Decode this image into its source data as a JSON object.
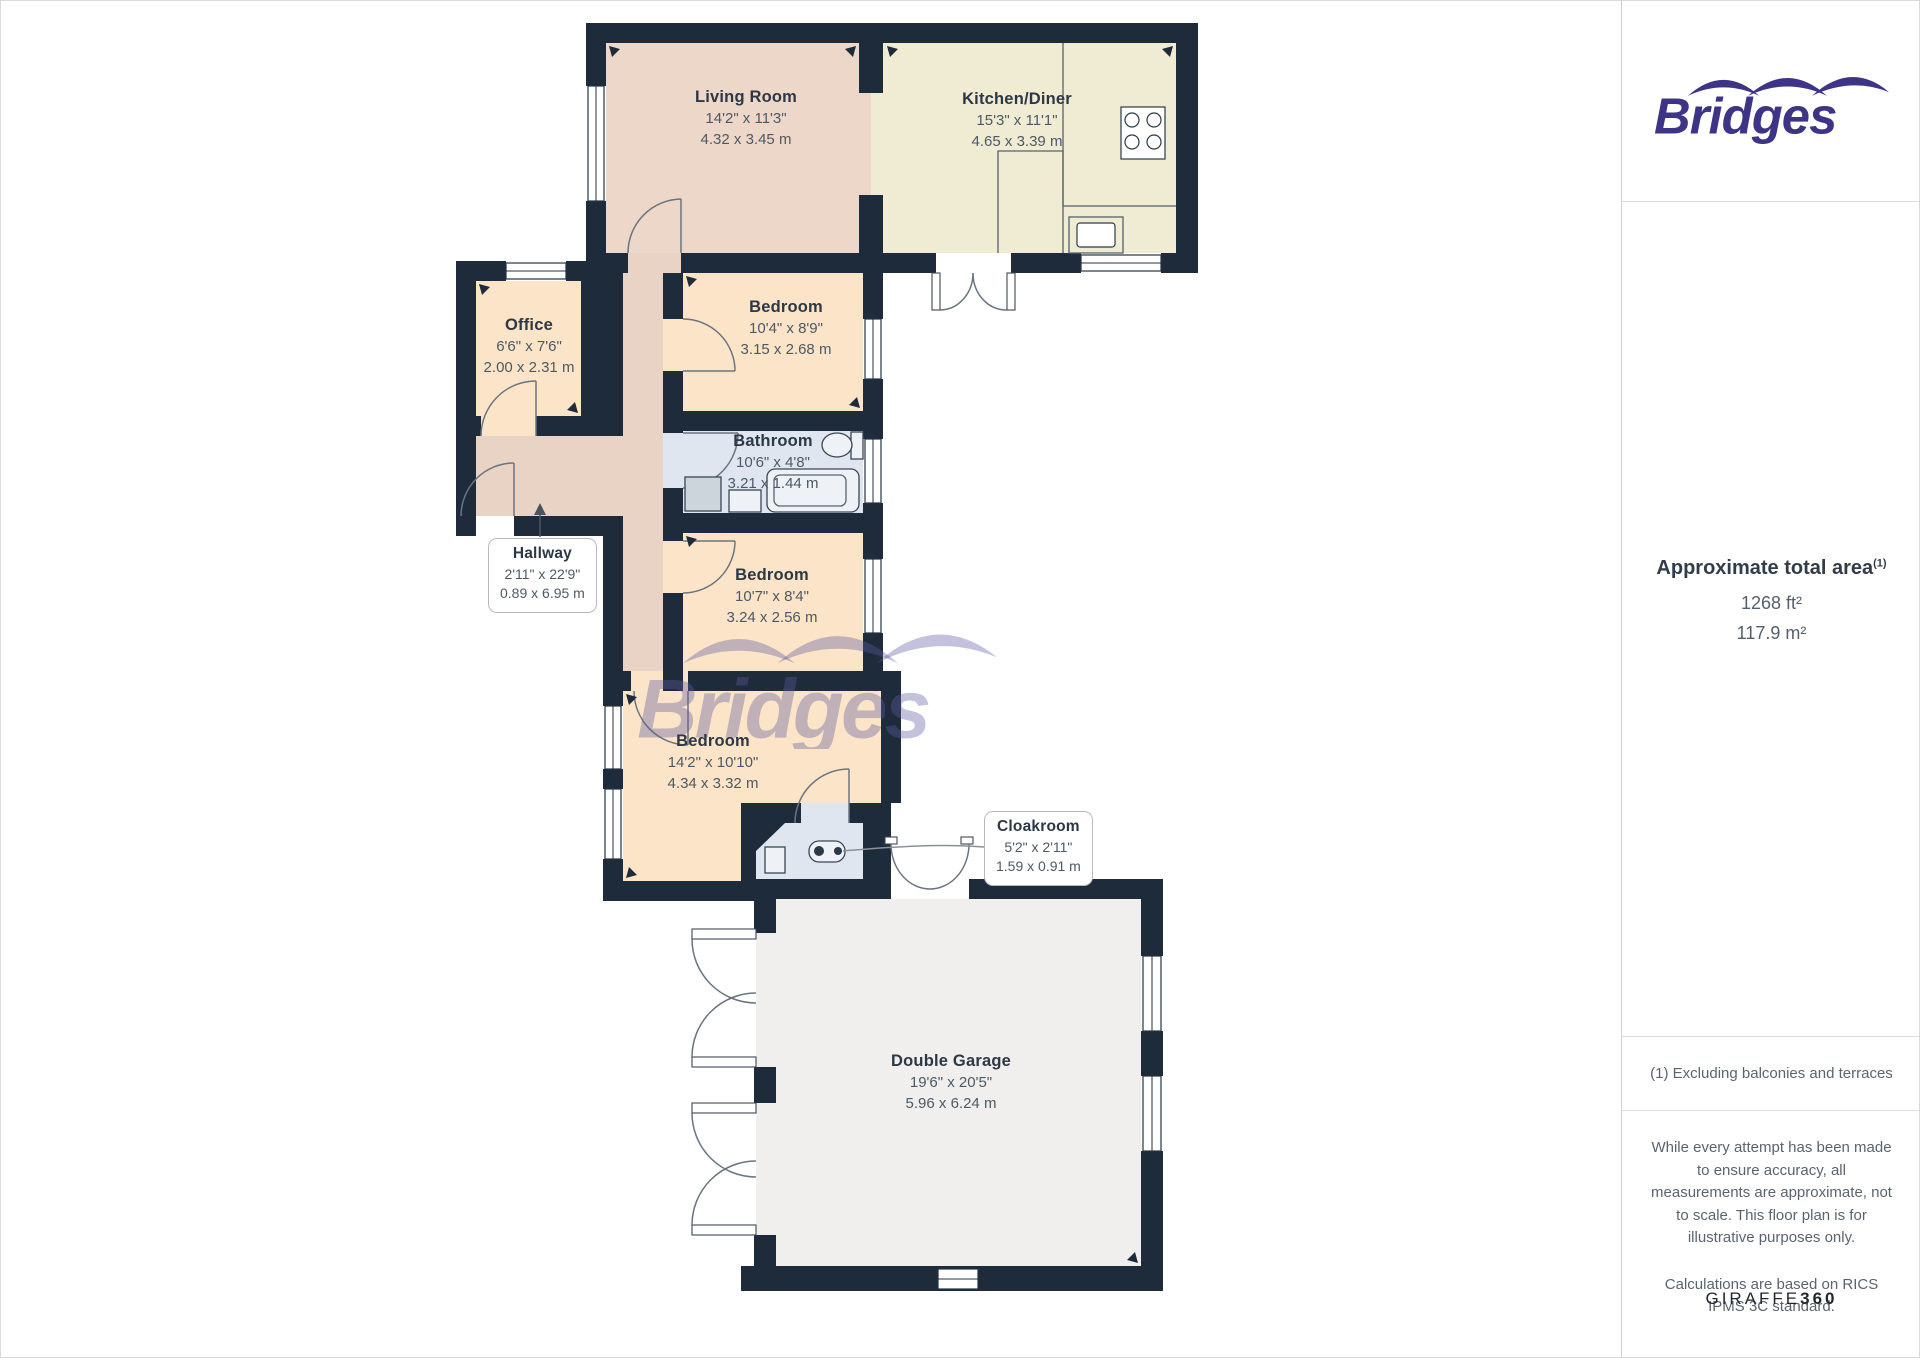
{
  "watermark": {
    "text": "Bridges"
  },
  "rooms": {
    "living_room": {
      "name": "Living Room",
      "imperial": "14'2\" x 11'3\"",
      "metric": "4.32 x 3.45 m"
    },
    "kitchen_diner": {
      "name": "Kitchen/Diner",
      "imperial": "15'3\" x 11'1\"",
      "metric": "4.65 x 3.39 m"
    },
    "office": {
      "name": "Office",
      "imperial": "6'6\" x 7'6\"",
      "metric": "2.00 x 2.31 m"
    },
    "bedroom_1": {
      "name": "Bedroom",
      "imperial": "10'4\" x 8'9\"",
      "metric": "3.15 x 2.68 m"
    },
    "bathroom": {
      "name": "Bathroom",
      "imperial": "10'6\" x 4'8\"",
      "metric": "3.21 x 1.44 m"
    },
    "hallway": {
      "name": "Hallway",
      "imperial": "2'11\" x 22'9\"",
      "metric": "0.89 x 6.95 m"
    },
    "bedroom_2": {
      "name": "Bedroom",
      "imperial": "10'7\" x 8'4\"",
      "metric": "3.24 x 2.56 m"
    },
    "bedroom_3": {
      "name": "Bedroom",
      "imperial": "14'2\" x 10'10\"",
      "metric": "4.34 x 3.32 m"
    },
    "cloakroom": {
      "name": "Cloakroom",
      "imperial": "5'2\" x 2'11\"",
      "metric": "1.59 x 0.91 m"
    },
    "double_garage": {
      "name": "Double Garage",
      "imperial": "19'6\" x 20'5\"",
      "metric": "5.96 x 6.24 m"
    }
  },
  "sidebar": {
    "brand": "Bridges",
    "area": {
      "title": "Approximate total area",
      "superscript": "(1)",
      "imperial": "1268 ft²",
      "metric": "117.9 m²"
    },
    "footnote": "(1) Excluding balconies and terraces",
    "disclaimer_1": "While every attempt has been made to ensure accuracy, all measurements are approximate, not to scale. This floor plan is for illustrative purposes only.",
    "disclaimer_2": "Calculations are based on RICS IPMS 3C standard.",
    "brand_footer_regular": "GIRAFFE",
    "brand_footer_bold": "360"
  },
  "colors": {
    "wall": "#1e2b3b",
    "living_room": "#edd7c9",
    "kitchen": "#f0ebd3",
    "bedroom": "#fbe4c7",
    "hallway": "#e9d3c5",
    "bathroom": "#dfe6f0",
    "garage": "#f0efed",
    "brand": "#3d3487",
    "watermark": "rgba(98,92,160,0.38)"
  }
}
